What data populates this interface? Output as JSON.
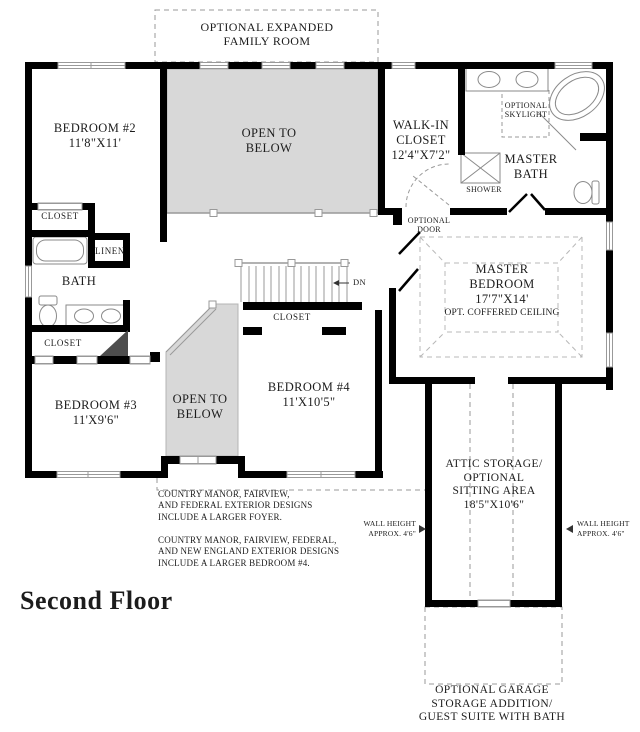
{
  "title": "Second Floor",
  "plan": {
    "colors": {
      "wall": "#000000",
      "open_area_fill": "#d8d8d8",
      "fixture_line": "#8a8a8a",
      "dashed_line": "#9a9a9a",
      "text": "#1c1c1c"
    },
    "labels": {
      "optional_family_room": "OPTIONAL EXPANDED\nFAMILY ROOM",
      "bedroom2": "BEDROOM #2\n11'8\"X11'",
      "open_to_below_top": "OPEN TO\nBELOW",
      "walk_in_closet": "WALK-IN\nCLOSET\n12'4\"X7'2\"",
      "optional_skylight": "OPTIONAL\nSKYLIGHT",
      "master_bath": "MASTER\nBATH",
      "shower": "SHOWER",
      "optional_door": "OPTIONAL\nDOOR",
      "closet_bedroom2": "CLOSET",
      "linen": "LINEN",
      "bath": "BATH",
      "closet_hall": "CLOSET",
      "master_bedroom": "MASTER\nBEDROOM\n17'7\"X14'",
      "master_bedroom_ceiling": "OPT. COFFERED CEILING",
      "stairs_dn": "DN",
      "closet_bedroom4": "CLOSET",
      "bedroom4": "BEDROOM #4\n11'X10'5\"",
      "bedroom3": "BEDROOM #3\n11'X9'6\"",
      "open_to_below_bottom": "OPEN TO\nBELOW",
      "attic_storage": "ATTIC STORAGE/\nOPTIONAL\nSITTING AREA\n18'5\"X10'6\"",
      "wall_height_left": "WALL HEIGHT\nAPPROX. 4'6\"",
      "wall_height_right": "WALL HEIGHT\nAPPROX. 4'6\"",
      "note_foyer": "COUNTRY MANOR, FAIRVIEW,\nAND FEDERAL EXTERIOR DESIGNS\nINCLUDE A LARGER FOYER.",
      "note_bedroom4": "COUNTRY MANOR, FAIRVIEW, FEDERAL,\nAND NEW ENGLAND EXTERIOR DESIGNS\nINCLUDE A LARGER BEDROOM #4.",
      "garage_caption": "OPTIONAL GARAGE\nSTORAGE ADDITION/\nGUEST SUITE WITH BATH"
    }
  }
}
